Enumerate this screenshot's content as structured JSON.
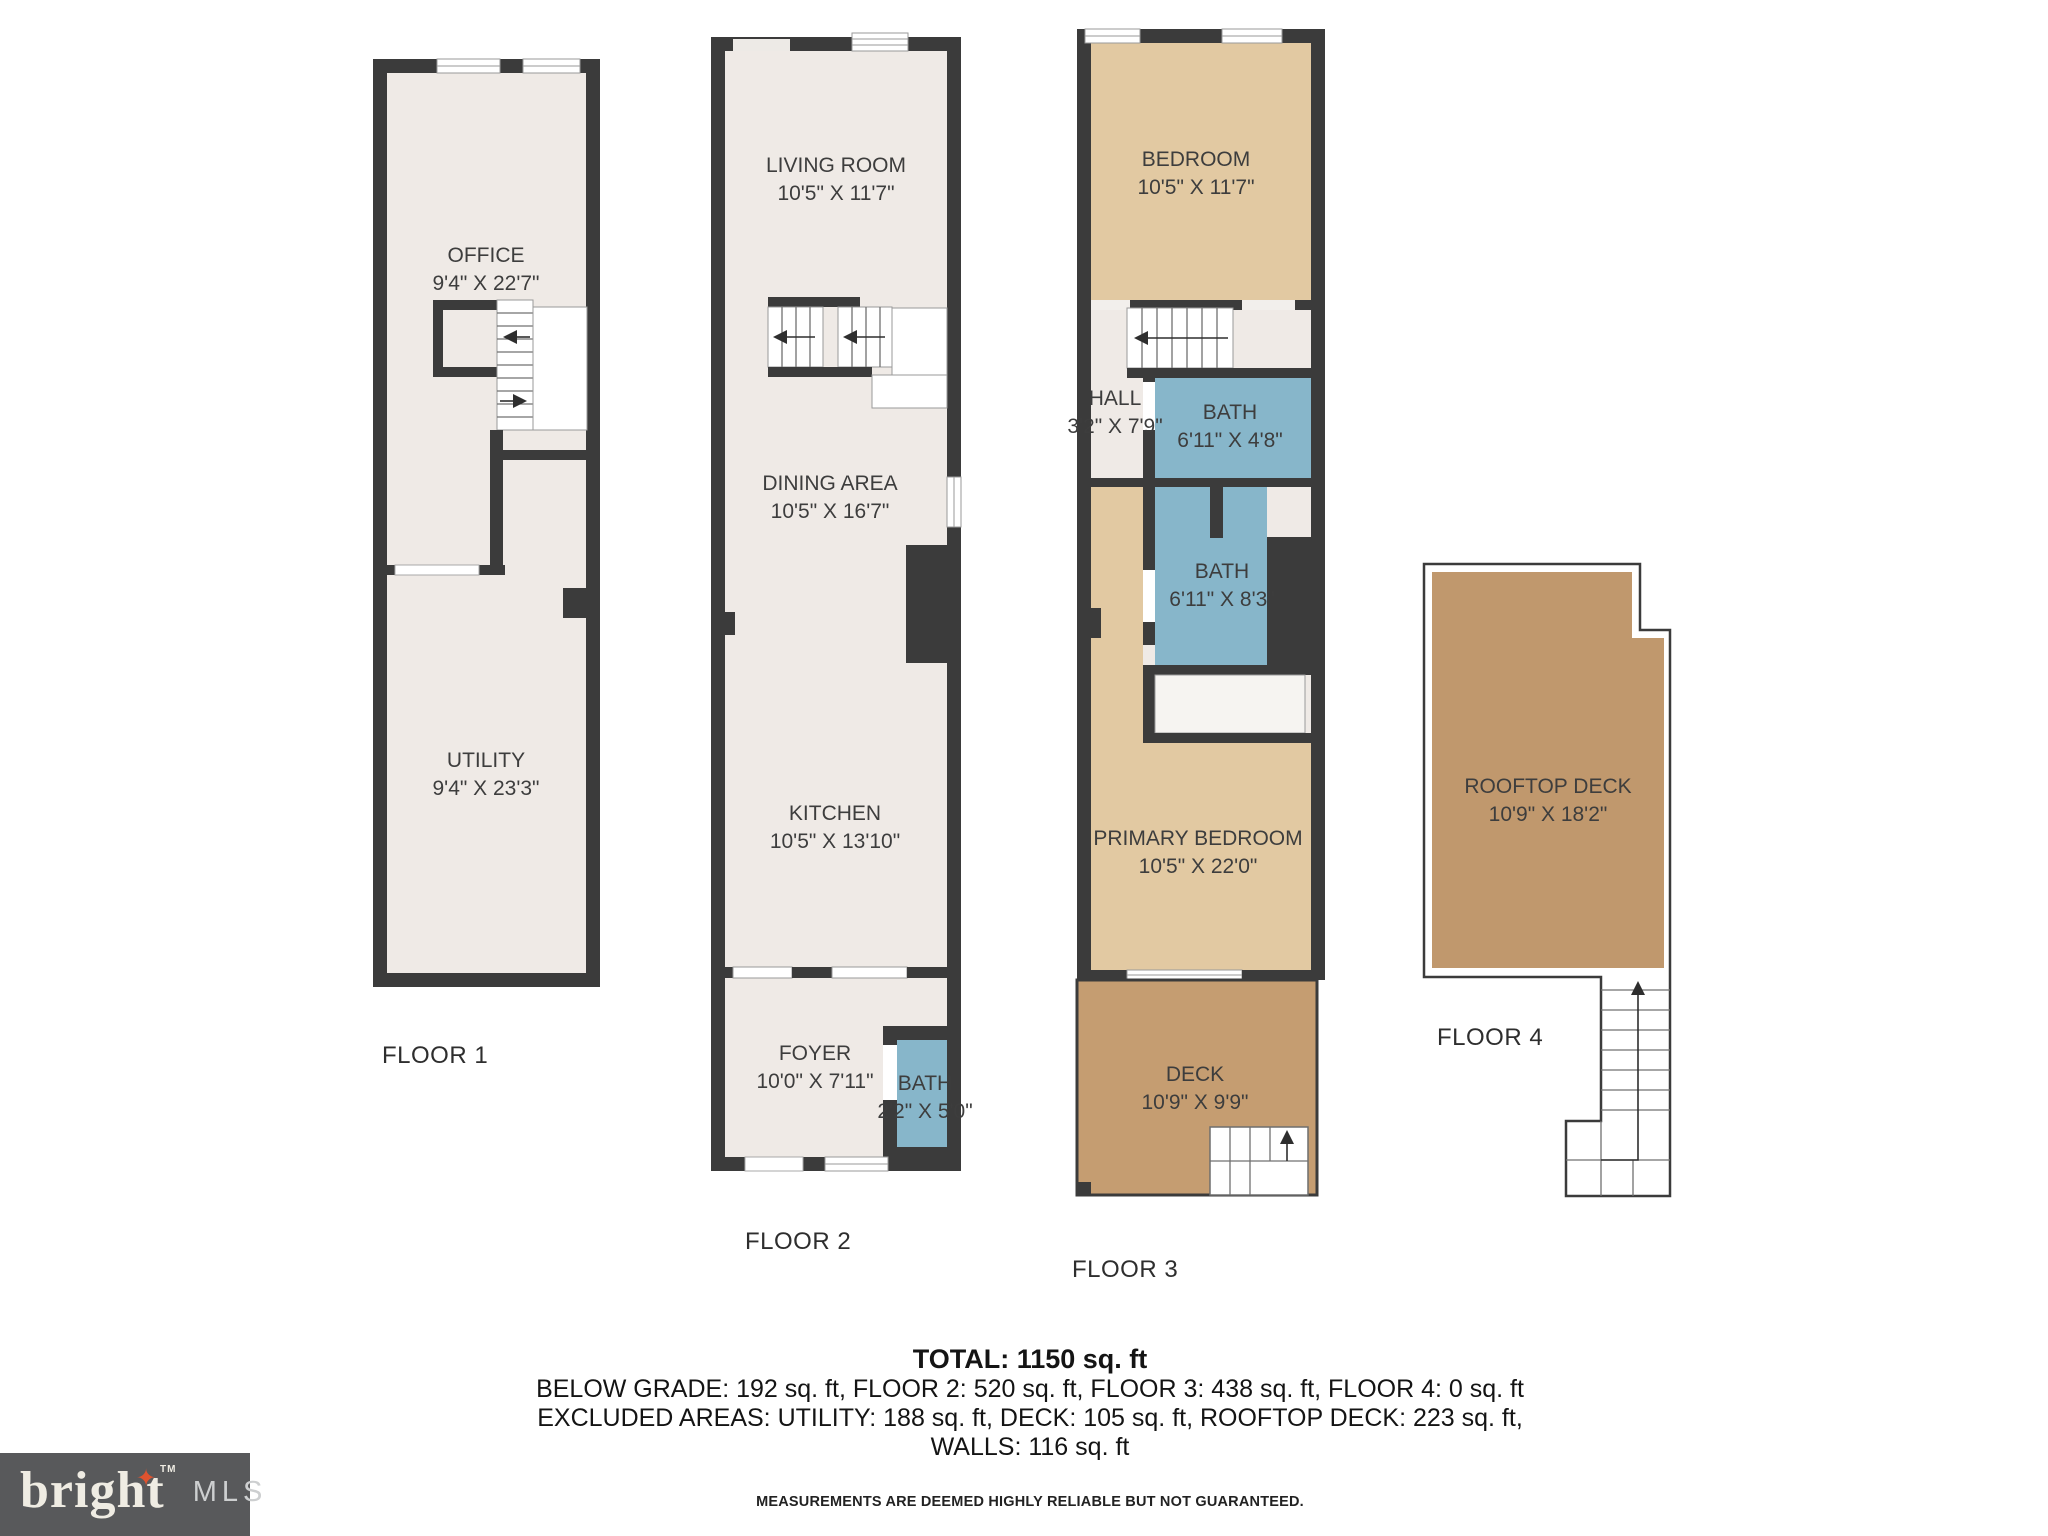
{
  "floors": [
    {
      "label": "FLOOR 1",
      "rooms": [
        {
          "name": "OFFICE",
          "dims": "9'4\" X 22'7\""
        },
        {
          "name": "UTILITY",
          "dims": "9'4\" X 23'3\""
        }
      ]
    },
    {
      "label": "FLOOR 2",
      "rooms": [
        {
          "name": "LIVING ROOM",
          "dims": "10'5\" X 11'7\""
        },
        {
          "name": "DINING AREA",
          "dims": "10'5\" X 16'7\""
        },
        {
          "name": "KITCHEN",
          "dims": "10'5\" X 13'10\""
        },
        {
          "name": "FOYER",
          "dims": "10'0\" X 7'11\""
        },
        {
          "name": "BATH",
          "dims": "2'2\" X 5'0\""
        }
      ]
    },
    {
      "label": "FLOOR 3",
      "rooms": [
        {
          "name": "BEDROOM",
          "dims": "10'5\" X 11'7\""
        },
        {
          "name": "HALL",
          "dims": "3'2\" X 7'9\""
        },
        {
          "name": "BATH",
          "dims": "6'11\" X 4'8\""
        },
        {
          "name": "BATH",
          "dims": "6'11\" X 8'3\""
        },
        {
          "name": "PRIMARY BEDROOM",
          "dims": "10'5\" X 22'0\""
        },
        {
          "name": "DECK",
          "dims": "10'9\" X 9'9\""
        }
      ]
    },
    {
      "label": "FLOOR 4",
      "rooms": [
        {
          "name": "ROOFTOP DECK",
          "dims": "10'9\" X 18'2\""
        }
      ]
    }
  ],
  "summary": {
    "total": "TOTAL: 1150 sq. ft",
    "breakdown": "BELOW GRADE: 192 sq. ft, FLOOR 2: 520 sq. ft, FLOOR 3: 438 sq. ft, FLOOR 4: 0 sq. ft",
    "excluded": "EXCLUDED AREAS: UTILITY: 188 sq. ft, DECK: 105 sq. ft, ROOFTOP DECK: 223 sq. ft,",
    "walls": "WALLS: 116 sq. ft",
    "disclaimer": "MEASUREMENTS ARE DEEMED HIGHLY RELIABLE BUT NOT GUARANTEED."
  },
  "logo": {
    "brand": "bright",
    "tm": "TM",
    "suffix": "MLS",
    "star": "✦"
  },
  "colors": {
    "wall": "#3b3b3b",
    "floor": "#efeae6",
    "bedroom_tan": "#e2c9a2",
    "deck_brown": "#c59d71",
    "rooftop_brown": "#c0986d",
    "bath_blue": "#87b6ca",
    "logo_background": "#58595b",
    "logo_star_orange": "#e0532f"
  }
}
